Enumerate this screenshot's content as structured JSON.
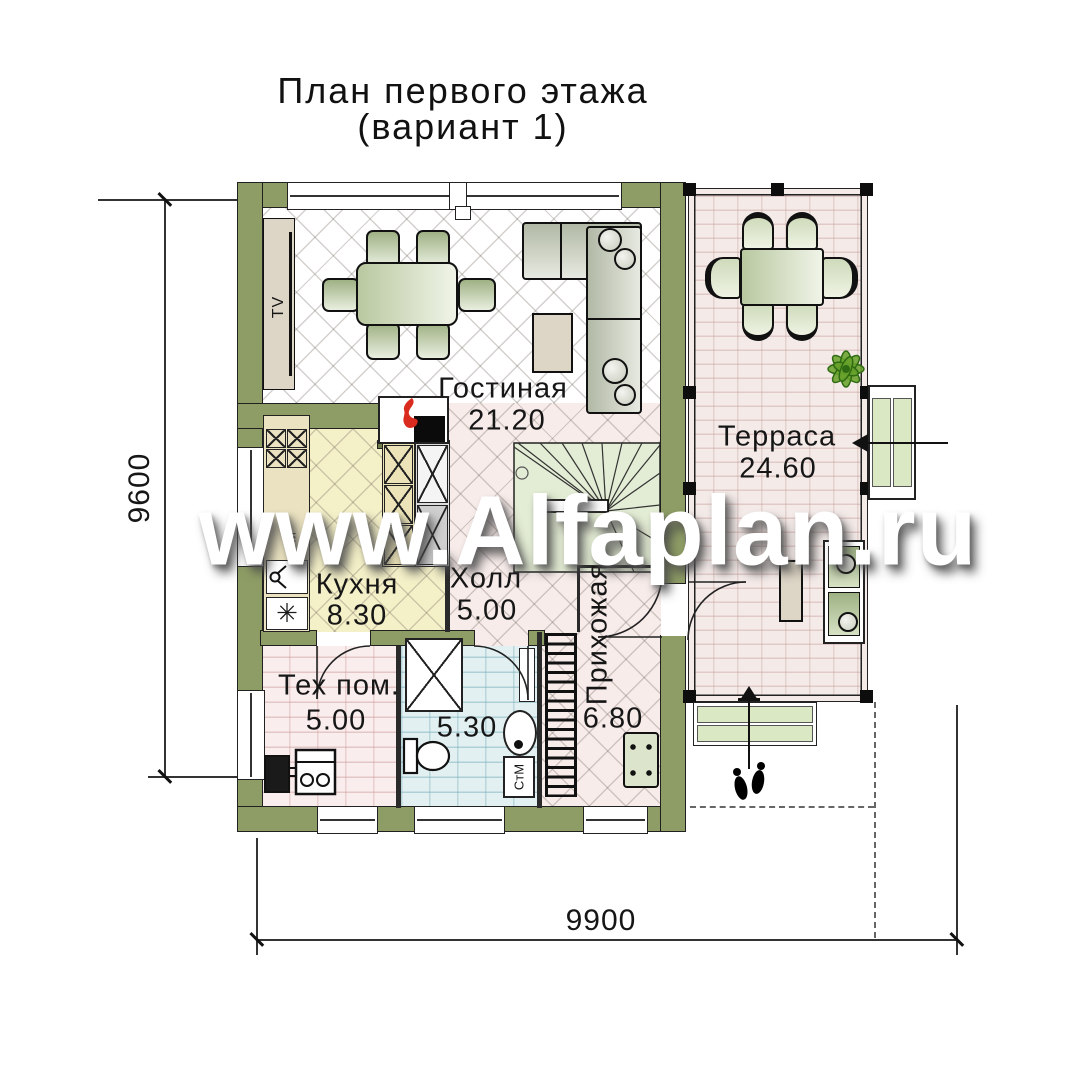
{
  "title": {
    "line1": "План первого этажа",
    "line2": "(вариант 1)"
  },
  "watermark": "www.Alfaplan.ru",
  "rooms": {
    "living": {
      "name": "Гостиная",
      "area": "21.20"
    },
    "terrace": {
      "name": "Терраса",
      "area": "24.60"
    },
    "kitchen": {
      "name": "Кухня",
      "area": "8.30"
    },
    "hall": {
      "name": "Холл",
      "area": "5.00"
    },
    "entry": {
      "name": "Прихожая",
      "area": "6.80"
    },
    "tech": {
      "name": "Тех пом.",
      "area": "5.00"
    },
    "bath": {
      "area": "5.30"
    }
  },
  "appliances": {
    "tv": "TV",
    "washing_machine": "СтМ",
    "dishwasher": "СМ",
    "fridge_symbol": "✳"
  },
  "dimensions": {
    "left": "9600",
    "bottom": "9900"
  },
  "colors": {
    "wall": "#8e9d65",
    "flame": "#d92b1e",
    "plant": "#5f9e2f"
  }
}
